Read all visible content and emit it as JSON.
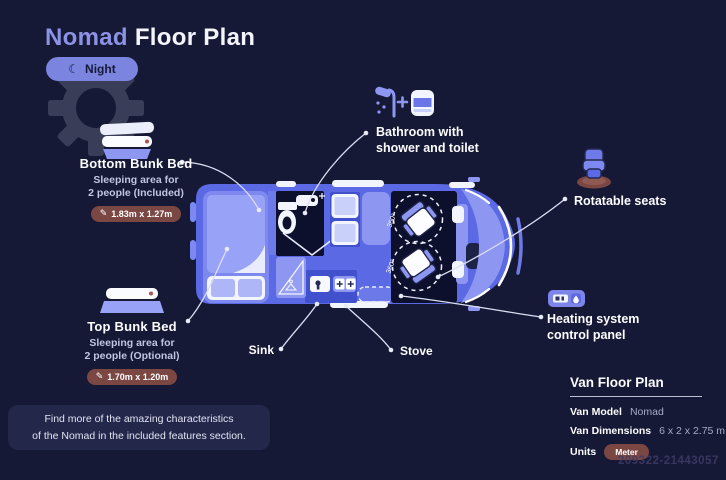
{
  "title": {
    "brand": "Nomad",
    "rest": "Floor Plan"
  },
  "mode_toggle": {
    "label": "Night"
  },
  "icons": {
    "moon": "☾",
    "ruler": "✎"
  },
  "callouts": {
    "bottom_bunk": {
      "title": "Bottom Bunk Bed",
      "sub_line1": "Sleeping area for",
      "sub_line2": "2 people (Included)",
      "dimensions": "1.83m x 1.27m"
    },
    "top_bunk": {
      "title": "Top Bunk Bed",
      "sub_line1": "Sleeping area for",
      "sub_line2": "2 people (Optional)",
      "dimensions": "1.70m x 1.20m"
    },
    "bathroom": {
      "line1": "Bathroom with",
      "line2": "shower and toilet"
    },
    "rotatable_seats": {
      "label": "Rotatable seats"
    },
    "heating": {
      "line1": "Heating system",
      "line2": "control panel"
    },
    "sink": {
      "label": "Sink"
    },
    "stove": {
      "label": "Stove"
    }
  },
  "floor_plan": {
    "rotation_label": "360°"
  },
  "footer_note": {
    "line1": "Find more of the amazing characteristics",
    "line2": "of the Nomad in the included features section."
  },
  "spec_panel": {
    "title": "Van Floor Plan",
    "rows": [
      {
        "label": "Van Model",
        "value": "Nomad"
      },
      {
        "label": "Van Dimensions",
        "value": "6 x 2 x 2.75 m"
      },
      {
        "label": "Units",
        "value": "Meter"
      }
    ]
  },
  "watermark_id": "209322-21443057",
  "colors": {
    "background": "#161936",
    "accent_periwinkle": "#8c93e4",
    "van_blue": "#5b69e4",
    "van_light": "#8d97f2",
    "interior_dark": "#0d102c",
    "pill_brown": "#7a4743",
    "text_muted": "#c2c5e2"
  }
}
